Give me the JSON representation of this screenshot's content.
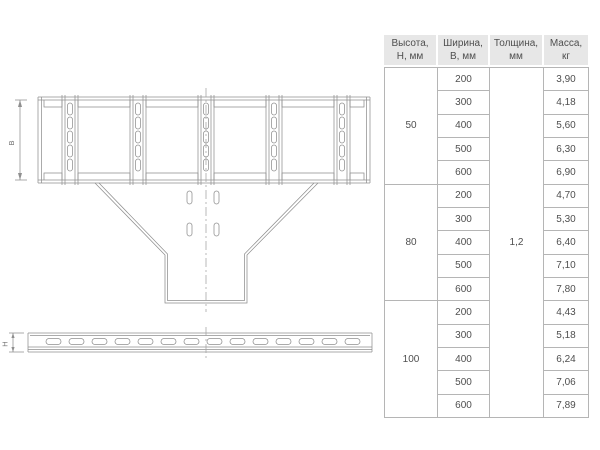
{
  "drawing": {
    "width_dim_label": "В",
    "height_dim_label": "Н"
  },
  "table": {
    "headers": [
      "Высота,\nН, мм",
      "Ширина,\nВ, мм",
      "Толщина,\nмм",
      "Масса,\nкг"
    ],
    "thickness": "1,2",
    "groups": [
      {
        "h": "50",
        "rows": [
          {
            "w": "200",
            "m": "3,90"
          },
          {
            "w": "300",
            "m": "4,18"
          },
          {
            "w": "400",
            "m": "5,60"
          },
          {
            "w": "500",
            "m": "6,30"
          },
          {
            "w": "600",
            "m": "6,90"
          }
        ]
      },
      {
        "h": "80",
        "rows": [
          {
            "w": "200",
            "m": "4,70"
          },
          {
            "w": "300",
            "m": "5,30"
          },
          {
            "w": "400",
            "m": "6,40"
          },
          {
            "w": "500",
            "m": "7,10"
          },
          {
            "w": "600",
            "m": "7,80"
          }
        ]
      },
      {
        "h": "100",
        "rows": [
          {
            "w": "200",
            "m": "4,43"
          },
          {
            "w": "300",
            "m": "5,18"
          },
          {
            "w": "400",
            "m": "6,24"
          },
          {
            "w": "500",
            "m": "7,06"
          },
          {
            "w": "600",
            "m": "7,89"
          }
        ]
      }
    ]
  }
}
